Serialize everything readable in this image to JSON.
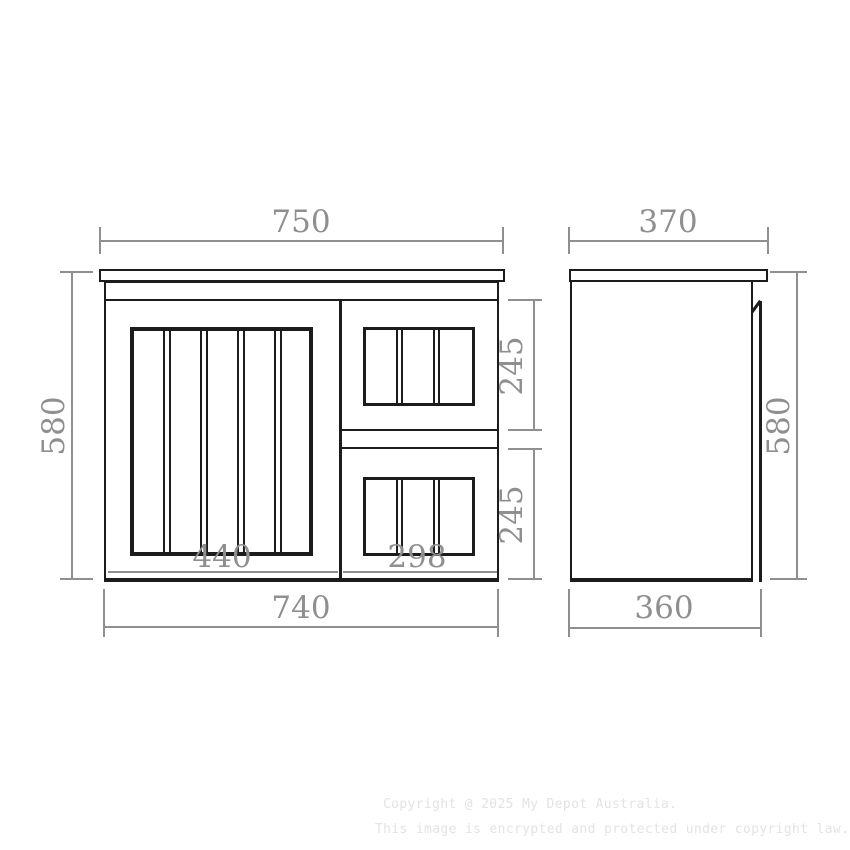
{
  "colors": {
    "line_black": "#1c1c1c",
    "dim_gray": "#8f8f8f",
    "watermark_gray": "#e3e3e3",
    "background": "#ffffff"
  },
  "front_view": {
    "dim_overall_width_top": "750",
    "dim_overall_height": "580",
    "dim_overall_width_bottom": "740",
    "dim_door_section_width": "440",
    "dim_drawer_section_width": "298",
    "dim_top_drawer_height": "245",
    "dim_bottom_drawer_height": "245"
  },
  "side_view": {
    "dim_depth_top": "370",
    "dim_overall_height": "580",
    "dim_depth_bottom": "360"
  },
  "watermark": {
    "line1": "Copyright @ 2025 My Depot Australia.",
    "line2": "This image is encrypted and protected under copyright law."
  }
}
